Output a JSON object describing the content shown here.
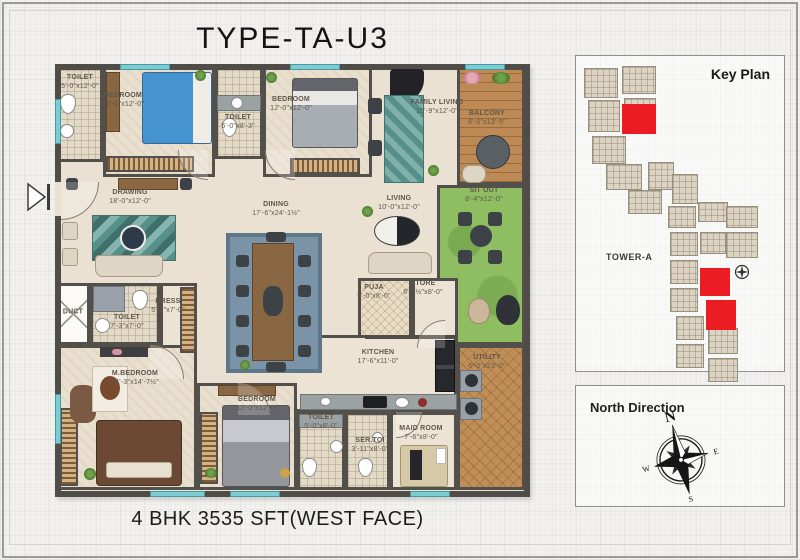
{
  "title": "TYPE-TA-U3",
  "footer": "4 BHK 3535 SFT(WEST FACE)",
  "rooms": {
    "toilet_tl": {
      "name": "TOILET",
      "dim": "5'-0\"x12'-0\""
    },
    "bedroom_tl": {
      "name": "BEDROOM",
      "dim": "12'-0\"x12'-0\""
    },
    "toilet_tm": {
      "name": "TOILET",
      "dim": "5'-0\"x8'-3\""
    },
    "bedroom_tm": {
      "name": "BEDROOM",
      "dim": "12'-0\"x12'-0\""
    },
    "family_living": {
      "name": "FAMILY LIVING",
      "dim": "10'-9\"x12'-0\""
    },
    "balcony": {
      "name": "BALCONY",
      "dim": "6'-0\"x13'-5\""
    },
    "drawing": {
      "name": "DRAWING",
      "dim": "18'-0\"x12'-0\""
    },
    "dining": {
      "name": "DINING",
      "dim": "17'-6\"x24'-1½\""
    },
    "living": {
      "name": "LIVING",
      "dim": "10'-0\"x12'-0\""
    },
    "sit_out": {
      "name": "SIT OUT",
      "dim": "8'-4\"x12'-0\""
    },
    "duct": {
      "name": "DUCT",
      "dim": ""
    },
    "toilet_m": {
      "name": "TOILET",
      "dim": "7'-3\"x7'-0\""
    },
    "dress": {
      "name": "DRESS",
      "dim": "5'-0\"x7'-0\""
    },
    "m_bedroom": {
      "name": "M.BEDROOM",
      "dim": "14'-3\"x14'-7½\""
    },
    "puja": {
      "name": "PUJA",
      "dim": "5'-0\"x8'-0\""
    },
    "store": {
      "name": "STORE",
      "dim": "6'-5½\"x8'-0\""
    },
    "kitchen": {
      "name": "KITCHEN",
      "dim": "17'-6\"x11'-0\""
    },
    "utility": {
      "name": "UTILITY",
      "dim": "6'-0\"x23'-0\""
    },
    "bedroom_b": {
      "name": "BEDROOM",
      "dim": "12'-0\"x12'-0\""
    },
    "toilet_b": {
      "name": "TOILET",
      "dim": "5'-0\"x8'-0\""
    },
    "ser_toi": {
      "name": "SER.TOI",
      "dim": "3'-11\"x8'-0\""
    },
    "maid": {
      "name": "MAID ROOM",
      "dim": "7'-6\"x8'-0\""
    }
  },
  "key_plan": {
    "title": "Key Plan",
    "tower_label": "TOWER-A",
    "highlight_color": "#ec1c24",
    "buildings": [
      [
        8,
        12,
        34,
        30
      ],
      [
        46,
        10,
        34,
        28
      ],
      [
        12,
        44,
        32,
        32
      ],
      [
        48,
        42,
        32,
        30
      ],
      [
        16,
        80,
        34,
        28
      ],
      [
        30,
        108,
        36,
        26
      ],
      [
        52,
        134,
        34,
        24
      ],
      [
        72,
        106,
        26,
        28
      ],
      [
        96,
        118,
        26,
        30
      ],
      [
        92,
        150,
        28,
        22
      ],
      [
        122,
        146,
        30,
        20
      ],
      [
        150,
        150,
        32,
        22
      ],
      [
        150,
        176,
        32,
        26
      ],
      [
        124,
        176,
        26,
        22
      ],
      [
        94,
        176,
        28,
        24
      ],
      [
        94,
        204,
        28,
        24
      ],
      [
        94,
        232,
        28,
        24
      ],
      [
        100,
        260,
        28,
        24
      ],
      [
        132,
        272,
        30,
        26
      ],
      [
        100,
        288,
        28,
        24
      ],
      [
        132,
        302,
        30,
        24
      ]
    ],
    "highlights": [
      [
        46,
        48,
        34,
        30
      ],
      [
        124,
        212,
        30,
        28
      ],
      [
        130,
        244,
        30,
        30
      ]
    ]
  },
  "north_panel": {
    "title": "North Direction",
    "n": "N",
    "e": "E",
    "s": "S",
    "w": "W"
  }
}
